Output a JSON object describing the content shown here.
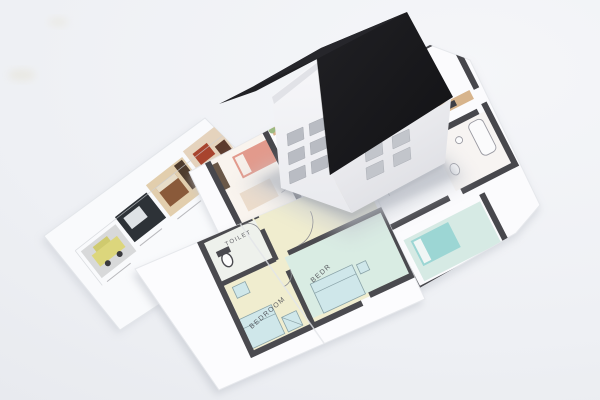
{
  "scene": {
    "description": "White paper model house with a black gabled roof standing on overlapping printed architectural floor plans lying on a light tabletop"
  },
  "palette": {
    "background": "#eef0f4",
    "paper": "#fbfbfd",
    "roof_dark": "#1b1b1f",
    "roof_light": "#26262b",
    "wall_light": "#f3f3f6",
    "wall_shaded": "#e8e9ed",
    "window_glass": "#b9bcc3",
    "plan_wall": "#47474c",
    "salmon": "#e29a8c",
    "teal_bed": "#8ed1d1",
    "tan_furniture": "#d7b48c",
    "floor_yellow": "#f0edcf",
    "pale_teal_room": "#d9ece3",
    "car_yellow": "#dcd67c"
  },
  "house": {
    "left_wall_windows": 6,
    "right_wall_windows": 4,
    "roof_panels": 2
  },
  "plans": {
    "front_sheet": {
      "labels": [
        {
          "text": "SHWR"
        },
        {
          "text": "BA"
        },
        {
          "text": "TOILET"
        },
        {
          "text": "BEDROOM"
        },
        {
          "text": "BEDR"
        }
      ]
    },
    "center_sheet": {
      "description": "furnished color floor plan with dark walls"
    },
    "left_sheet": {
      "description": "strip of interior renderings"
    }
  }
}
